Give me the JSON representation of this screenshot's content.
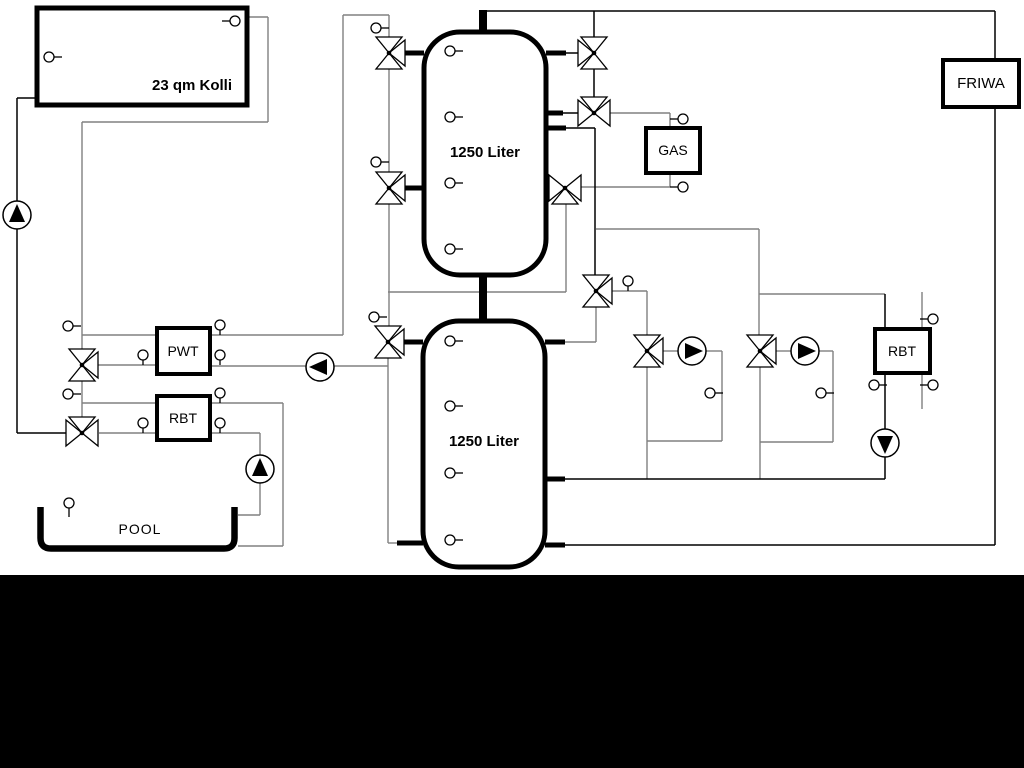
{
  "diagram": {
    "labels": {
      "collector": "23 qm Kolli",
      "tank_top": "1250 Liter",
      "tank_bottom": "1250 Liter",
      "pwt": "PWT",
      "rbt_left": "RBT",
      "gas": "GAS",
      "friwa": "FRIWA",
      "rbt_right": "RBT",
      "pool": "POOL"
    },
    "colors": {
      "background": "#ffffff",
      "pipe_gray": "#808080",
      "pipe_black": "#000000",
      "outline": "#000000",
      "bottom_band": "#000000"
    }
  }
}
